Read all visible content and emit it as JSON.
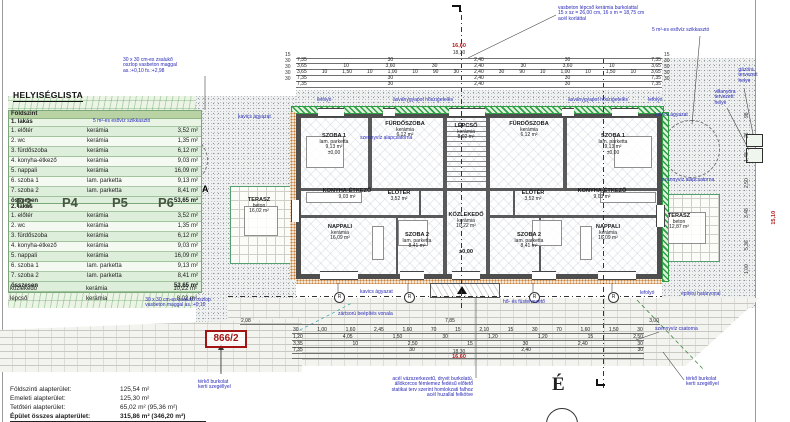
{
  "heading": "HELYISÉGLISTA",
  "parcel_number": "866/2",
  "north_label": "É",
  "r_marker_label": "R",
  "colors": {
    "annotation_blue": "#2a2ab8",
    "highlight_red": "#b01818",
    "table_green": "#ddeeda",
    "parking_green": "#44543f",
    "insulation_green": "#2f9e44"
  },
  "room_list": {
    "floor_label": "Földszint",
    "apartment1_label": "1. lakás",
    "apartment2_label": "2. lakás",
    "rows": [
      [
        "1. előtér",
        "kerámia",
        "3,52 m²"
      ],
      [
        "2. wc",
        "kerámia",
        "1,35 m²"
      ],
      [
        "3. fürdőszoba",
        "kerámia",
        "6,12 m²"
      ],
      [
        "4. konyha-étkező",
        "kerámia",
        "9,03 m²"
      ],
      [
        "5. nappali",
        "kerámia",
        "16,09 m²"
      ],
      [
        "6. szoba 1",
        "lam. parketta",
        "9,13 m²"
      ],
      [
        "7. szoba 2",
        "lam. parketta",
        "8,41 m²"
      ]
    ],
    "total_label": "összesen",
    "total_area": "53,65 m²",
    "extra_rows": [
      [
        "közlekedő",
        "kerámia",
        "10,22 m²"
      ],
      [
        "lépcső",
        "kerámia",
        "8,02 m²"
      ]
    ]
  },
  "parking_labels": [
    {
      "label": "P3",
      "x": 16
    },
    {
      "label": "P4",
      "x": 62
    },
    {
      "label": "P5",
      "x": 112
    },
    {
      "label": "P6",
      "x": 158
    }
  ],
  "summary": {
    "rows": [
      {
        "label": "Földszinti alapterület:",
        "value": "125,54 m²"
      },
      {
        "label": "Emeleti alapterület:",
        "value": "125,30 m²"
      },
      {
        "label": "Tetőtéri alapterület:",
        "value": "65,02 m² (95,36 m²)"
      },
      {
        "label": "Épület összes alapterület:",
        "value": "315,86 m² (346,20 m²)"
      }
    ]
  },
  "plan": {
    "r_markers": {
      "xs": [
        334,
        404,
        529,
        608
      ],
      "y": 292
    }
  },
  "dimensions": {
    "rows": [
      {
        "x": 296,
        "y": 52,
        "w": 366,
        "vals": []
      },
      {
        "x": 296,
        "y": 57,
        "w": 366,
        "vals": [
          "7,35",
          "30",
          "2,40",
          "30",
          "7,35"
        ]
      },
      {
        "x": 296,
        "y": 63,
        "w": 366,
        "vals": [
          "3,65",
          "10",
          "3,60",
          "30",
          "2,40",
          "30",
          "3,60",
          "10",
          "3,65"
        ]
      },
      {
        "x": 296,
        "y": 69,
        "w": 366,
        "vals": [
          "3,65",
          "10",
          "1,50",
          "10",
          "1,00",
          "10",
          "90",
          "30",
          "2,40",
          "30",
          "90",
          "10",
          "1,00",
          "10",
          "1,50",
          "10",
          "3,65"
        ]
      },
      {
        "x": 296,
        "y": 75,
        "w": 366,
        "vals": [
          "7,35",
          "30",
          "2,40",
          "30",
          "7,35"
        ]
      },
      {
        "x": 296,
        "y": 81,
        "w": 366,
        "vals": [
          "7,35",
          "30",
          "2,40",
          "30",
          "7,35"
        ]
      },
      {
        "x": 240,
        "y": 318,
        "w": 420,
        "vals": [
          "2,08",
          "7,85",
          "3,00"
        ]
      },
      {
        "x": 292,
        "y": 327,
        "w": 352,
        "vals": [
          "30",
          "1,00",
          "1,60",
          "2,45",
          "1,60",
          "70",
          "15",
          "2,10",
          "15",
          "30",
          "70",
          "1,60",
          "1,50",
          "30"
        ]
      },
      {
        "x": 292,
        "y": 334,
        "w": 352,
        "vals": [
          "1,20",
          "4,05",
          "1,50",
          "30",
          "1,20",
          "1,20",
          "15",
          "2,50"
        ]
      },
      {
        "x": 292,
        "y": 341,
        "w": 352,
        "vals": [
          "3,35",
          "10",
          "2,50",
          "15",
          "30",
          "2,40",
          "30"
        ]
      },
      {
        "x": 292,
        "y": 347,
        "w": 352,
        "vals": [
          "7,35",
          "30",
          "2,40",
          "30"
        ]
      },
      {
        "x": 292,
        "y": 352,
        "w": 352,
        "vals": []
      }
    ],
    "right_vertical": [
      {
        "x": 744,
        "y": 118,
        "t": "98"
      },
      {
        "x": 744,
        "y": 138,
        "t": "26"
      },
      {
        "x": 744,
        "y": 162,
        "t": "1,48"
      },
      {
        "x": 744,
        "y": 188,
        "t": "2,50"
      },
      {
        "x": 744,
        "y": 218,
        "t": "3,48"
      },
      {
        "x": 744,
        "y": 250,
        "t": "5,36"
      },
      {
        "x": 744,
        "y": 274,
        "t": "1,00"
      }
    ]
  },
  "positioned_texts": [
    {
      "n": "note-lefolyo-top-left",
      "x": 317,
      "y": 98,
      "cls": "anno",
      "lines": [
        "lefolyó"
      ]
    },
    {
      "n": "note-insulation-left",
      "x": 393,
      "y": 98,
      "cls": "anno",
      "lines": [
        "ásványgyapot hőszigetelés"
      ]
    },
    {
      "n": "note-insulation-right",
      "x": 568,
      "y": 98,
      "cls": "anno",
      "lines": [
        "ásványgyapot hőszigetelés"
      ]
    },
    {
      "n": "note-lefolyo-top-right",
      "x": 648,
      "y": 98,
      "cls": "anno",
      "lines": [
        "lefolyó"
      ]
    },
    {
      "n": "note-stairs-spec",
      "x": 558,
      "y": 6,
      "cls": "anno",
      "lines": [
        "vasbeton lépcső kerámia burkolattal",
        "15 x sz = 26,00 cm, 16 x m = 18,75 cm",
        "acél korláttal"
      ]
    },
    {
      "n": "note-soakaway-right",
      "x": 652,
      "y": 28,
      "cls": "anno",
      "lines": [
        "5 m²-es esővíz szikkasztó"
      ]
    },
    {
      "n": "note-gas-meter",
      "x": 748,
      "y": 68,
      "cls": "anno",
      "al": "c",
      "lines": [
        "gázóra",
        "tervezett",
        "helye"
      ]
    },
    {
      "n": "note-electric-meter",
      "x": 725,
      "y": 90,
      "cls": "anno",
      "al": "c",
      "lines": [
        "villanyóra",
        "tervezett",
        "helye"
      ]
    },
    {
      "n": "note-soakaway-left",
      "x": 93,
      "y": 119,
      "cls": "anno",
      "lines": [
        "5 m²-es esővíz szikkasztó"
      ]
    },
    {
      "n": "note-column-top",
      "x": 150,
      "y": 58,
      "cls": "anno",
      "al": "c",
      "lines": [
        "30 x 30 cm-es zsalukő",
        "oszlop vasbeton maggal",
        "as.:+0,10 fs.:+2,98"
      ]
    },
    {
      "n": "note-gravel-left",
      "x": 238,
      "y": 115,
      "cls": "anno",
      "lines": [
        "kavics ágyazat"
      ]
    },
    {
      "n": "note-gravel-right",
      "x": 655,
      "y": 113,
      "cls": "anno",
      "lines": [
        "kavics ágyazat"
      ]
    },
    {
      "n": "note-sewer-base-right",
      "x": 662,
      "y": 178,
      "cls": "anno",
      "lines": [
        "szennyvíz alapcsatorna"
      ]
    },
    {
      "n": "note-sewer-base-left",
      "x": 360,
      "y": 136,
      "cls": "anno",
      "lines": [
        "szennyvíz alapcsatorna"
      ]
    },
    {
      "n": "note-column-bottom",
      "x": 178,
      "y": 298,
      "cls": "anno",
      "al": "c",
      "lines": [
        "30 x 30 cm-es zsalukő oszlop",
        "vasbeton maggal as.:+0,10"
      ]
    },
    {
      "n": "note-gravel-bottom",
      "x": 360,
      "y": 290,
      "cls": "anno",
      "lines": [
        "kavics ágyazat"
      ]
    },
    {
      "n": "note-building-line",
      "x": 338,
      "y": 312,
      "cls": "anno",
      "lines": [
        "zártsorú beépítés vonala"
      ]
    },
    {
      "n": "note-smoke-vent",
      "x": 503,
      "y": 300,
      "cls": "anno",
      "lines": [
        "hő- és füstelvezető"
      ]
    },
    {
      "n": "note-lefolyo-bottom",
      "x": 640,
      "y": 291,
      "cls": "anno",
      "lines": [
        "lefolyó"
      ]
    },
    {
      "n": "note-boundary",
      "x": 681,
      "y": 292,
      "cls": "anno",
      "lines": [
        "építési határvonal"
      ]
    },
    {
      "n": "note-sewer-channel",
      "x": 655,
      "y": 327,
      "cls": "anno",
      "lines": [
        "szennyvíz csatorna"
      ]
    },
    {
      "n": "note-paving-right",
      "x": 686,
      "y": 377,
      "cls": "anno",
      "lines": [
        "térkő burkolat",
        "kerti szegéllyel"
      ]
    },
    {
      "n": "note-paving-left",
      "x": 198,
      "y": 380,
      "cls": "anno",
      "lines": [
        "térkő burkolat",
        "kerti szegéllyel"
      ]
    },
    {
      "n": "note-canopy",
      "x": 333,
      "y": 377,
      "cls": "anno",
      "w": 140,
      "al": "r",
      "lines": [
        "acél vázszerkezetű, dryvit burkolatú,",
        "állókorcos fémlemez fedésű előtető",
        "statikai terv szerint homlokzati falhoz",
        "acél huzallal felkötve"
      ]
    },
    {
      "n": "dim-total-top-red",
      "x": 459,
      "y": 44,
      "cls": "red",
      "al": "c",
      "lines": [
        "16,60"
      ]
    },
    {
      "n": "dim-total-top",
      "x": 459,
      "y": 50,
      "cls": "dim",
      "al": "c",
      "lines": [
        "18,30"
      ]
    },
    {
      "n": "dim-total-bottom",
      "x": 459,
      "y": 349,
      "cls": "dim",
      "al": "c",
      "lines": [
        "18,30"
      ]
    },
    {
      "n": "dim-total-bottom-red",
      "x": 459,
      "y": 355,
      "cls": "red",
      "al": "c",
      "lines": [
        "16,60"
      ]
    },
    {
      "n": "dim-right-total-red",
      "x": 768,
      "y": 215,
      "cls": "red",
      "rot": 1,
      "lines": [
        "15,10"
      ]
    },
    {
      "n": "room-szoba1-left",
      "x": 334,
      "y": 134,
      "cls": "room",
      "al": "c",
      "lines": [
        "SZOBA 1",
        "lam. parketta",
        "9,13 m²",
        "±0,00"
      ]
    },
    {
      "n": "room-furdoszoba-left",
      "x": 405,
      "y": 122,
      "cls": "room",
      "al": "c",
      "lines": [
        "FÜRDŐSZOBA",
        "kerámia",
        "6,12 m²"
      ]
    },
    {
      "n": "room-lepcso",
      "x": 466,
      "y": 124,
      "cls": "room",
      "al": "c",
      "lines": [
        "LÉPCSŐ",
        "kerámia",
        "8,02 m²"
      ]
    },
    {
      "n": "room-furdoszoba-right",
      "x": 529,
      "y": 122,
      "cls": "room",
      "al": "c",
      "lines": [
        "FÜRDŐSZOBA",
        "kerámia",
        "6,12 m²"
      ]
    },
    {
      "n": "room-szoba1-right",
      "x": 613,
      "y": 134,
      "cls": "room",
      "al": "c",
      "lines": [
        "SZOBA 1",
        "lam. parketta",
        "9,13 m²",
        "±0,00"
      ]
    },
    {
      "n": "room-konyha-left",
      "x": 347,
      "y": 189,
      "cls": "room",
      "al": "c",
      "lines": [
        "KONYHA-ÉTKEZŐ",
        "9,03 m²"
      ]
    },
    {
      "n": "room-eloter-left",
      "x": 399,
      "y": 191,
      "cls": "room",
      "al": "c",
      "lines": [
        "ELŐTÉR",
        "3,52 m²"
      ]
    },
    {
      "n": "room-kozlekedo",
      "x": 466,
      "y": 213,
      "cls": "room",
      "al": "c",
      "lines": [
        "KÖZLEKEDŐ",
        "kerámia",
        "10,22 m²"
      ]
    },
    {
      "n": "level-mark",
      "x": 466,
      "y": 250,
      "cls": "room",
      "al": "c",
      "lines": [
        "±0,00"
      ]
    },
    {
      "n": "room-eloter-right",
      "x": 533,
      "y": 191,
      "cls": "room",
      "al": "c",
      "lines": [
        "ELŐTÉR",
        "3,52 m²"
      ]
    },
    {
      "n": "room-konyha-right",
      "x": 602,
      "y": 189,
      "cls": "room",
      "al": "c",
      "lines": [
        "KONYHA-ÉTKEZŐ",
        "9,03 m²"
      ]
    },
    {
      "n": "room-nappali-left",
      "x": 340,
      "y": 225,
      "cls": "room",
      "al": "c",
      "lines": [
        "NAPPALI",
        "kerámia",
        "16,09 m²"
      ]
    },
    {
      "n": "room-szoba2-left",
      "x": 417,
      "y": 233,
      "cls": "room",
      "al": "c",
      "lines": [
        "SZOBA 2",
        "lam. parketta",
        "8,41 m²"
      ]
    },
    {
      "n": "room-szoba2-right",
      "x": 529,
      "y": 233,
      "cls": "room",
      "al": "c",
      "lines": [
        "SZOBA 2",
        "lam. parketta",
        "8,41 m²"
      ]
    },
    {
      "n": "room-nappali-right",
      "x": 608,
      "y": 225,
      "cls": "room",
      "al": "c",
      "lines": [
        "NAPPALI",
        "kerámia",
        "16,09 m²"
      ]
    },
    {
      "n": "room-terasz-left",
      "x": 259,
      "y": 198,
      "cls": "room",
      "al": "c",
      "lines": [
        "TERASZ",
        "beton",
        "16,02 m²"
      ]
    },
    {
      "n": "room-terasz-right",
      "x": 679,
      "y": 214,
      "cls": "room",
      "al": "c",
      "lines": [
        "TERASZ",
        "beton",
        "12,87 m²"
      ]
    },
    {
      "n": "section-marker-a",
      "x": 202,
      "y": 184,
      "cls": "marker",
      "lines": [
        "A"
      ]
    },
    {
      "n": "dim-ticks-left",
      "x": 285,
      "y": 52,
      "cls": "dim",
      "lines": [
        "15",
        "30",
        "30",
        "30",
        "30"
      ]
    },
    {
      "n": "dim-ticks-right",
      "x": 664,
      "y": 52,
      "cls": "dim",
      "lines": [
        "15",
        "30",
        "30",
        "30",
        "30"
      ]
    }
  ]
}
